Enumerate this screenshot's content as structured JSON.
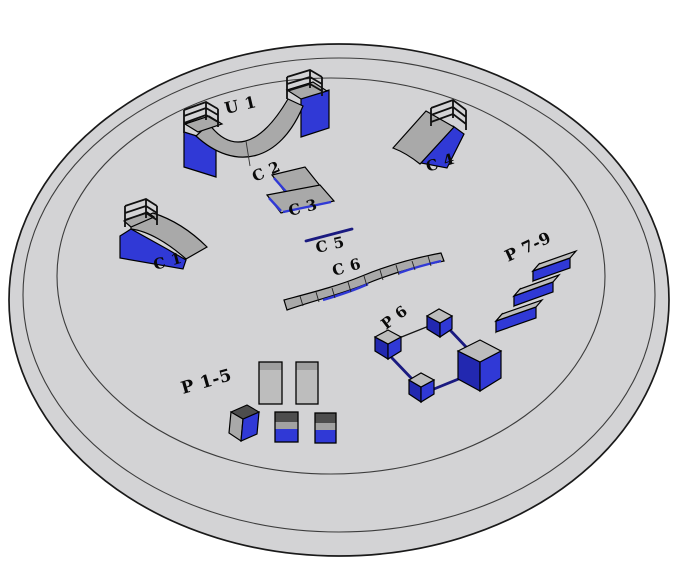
{
  "labels": {
    "u1": "U 1",
    "c1": "C 1",
    "c2": "C 2",
    "c3": "C 3",
    "c4": "C 4",
    "c5": "C 5",
    "c6": "C 6",
    "p1_5": "P 1-5",
    "p6": "P 6",
    "p7_9": "P 7-9"
  },
  "colors": {
    "background": "#ffffff",
    "pad": "#d3d3d5",
    "pad_outline": "#1a1a1a",
    "ring": "#3c3c3c",
    "surface": "#a9a9a9",
    "surface_light": "#bdbdbd",
    "surface_dark": "#787878",
    "panel_dark": "#4d4d4d",
    "blue": "#3039d6",
    "blue_dark": "#2228b0",
    "rail_navy": "#1a1a80",
    "outline": "#000000",
    "label": "#0a0a0a"
  }
}
